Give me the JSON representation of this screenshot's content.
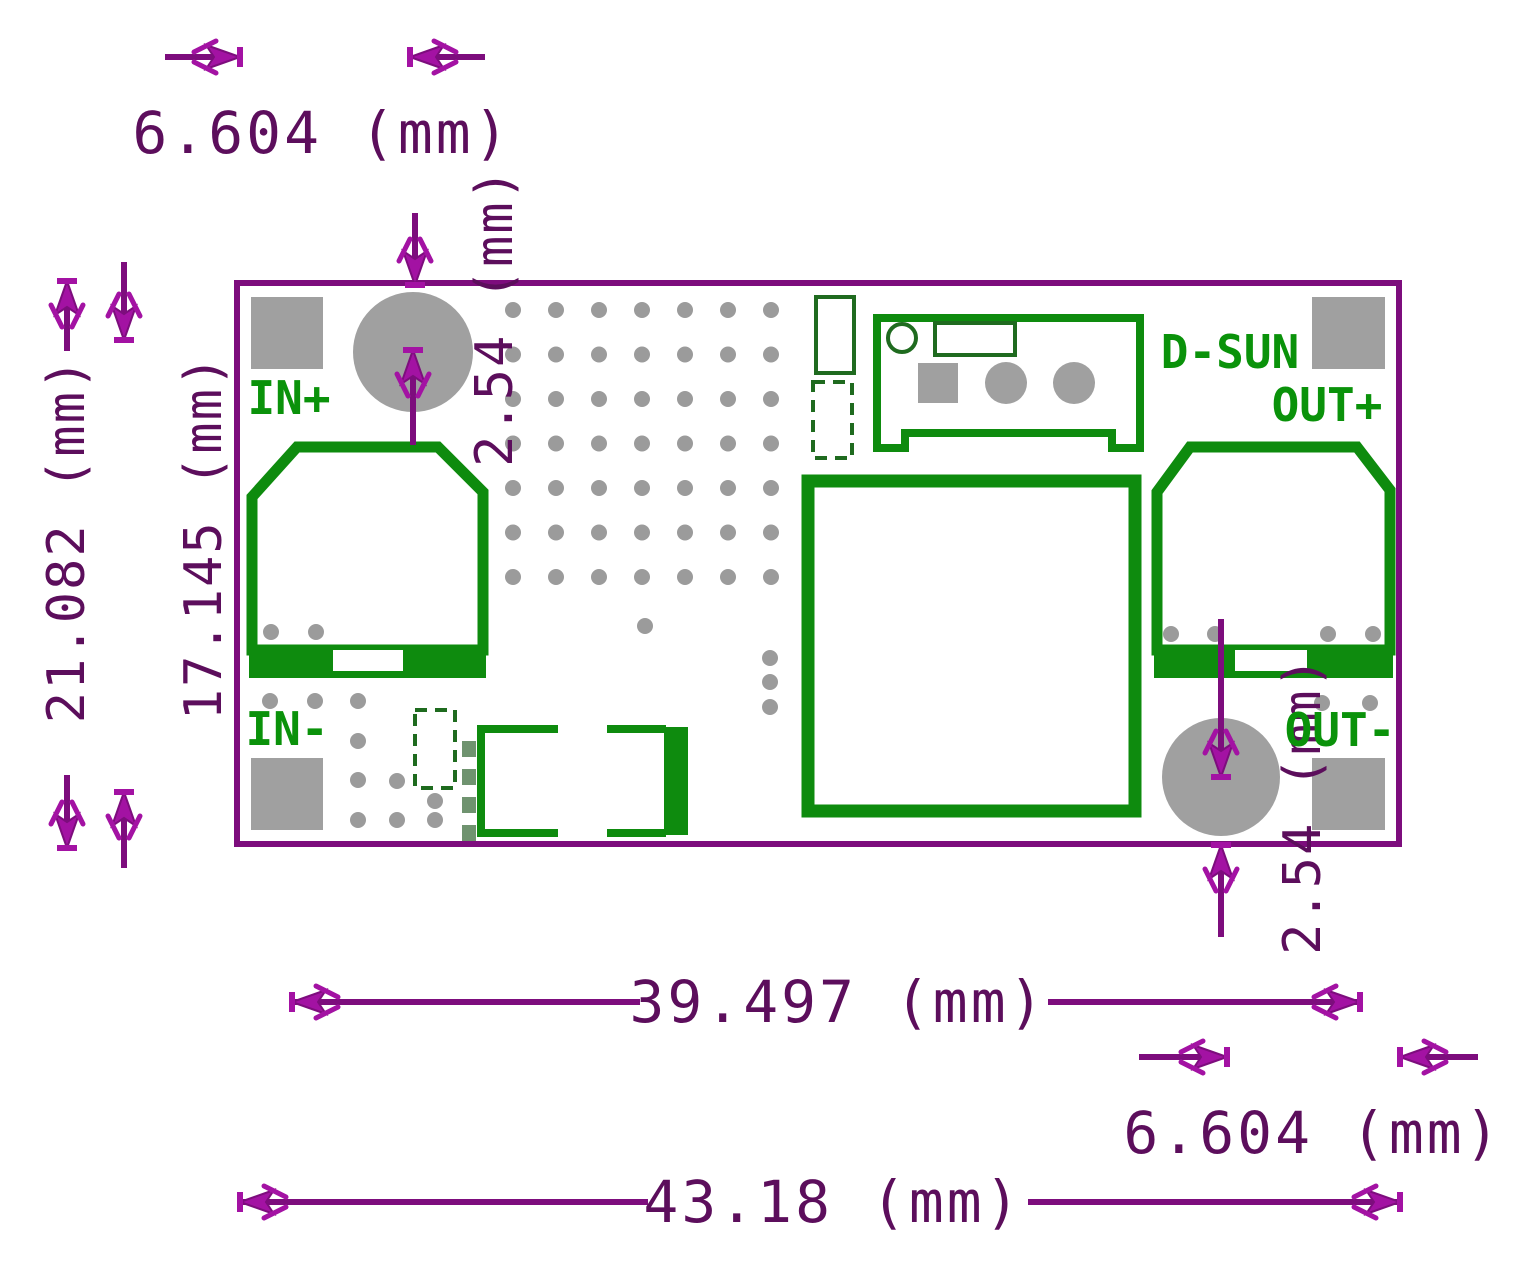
{
  "colors": {
    "dimension_text": "#5c0e5c",
    "dimension_line": "#7d0d7d",
    "arrow_fill": "#a312a3",
    "board_outline": "#7d0d7d",
    "silkscreen_green": "#0e8b0e",
    "silkscreen_dark_green": "#1f6b1f",
    "label_green": "#0a920a",
    "pad_gray": "#a0a0a0",
    "via_gray": "#9b9b9b",
    "background": "#ffffff"
  },
  "module": {
    "brand": "D-SUN",
    "pin_labels": {
      "in_plus": "IN+",
      "in_minus": "IN-",
      "out_plus": "OUT+",
      "out_minus": "OUT-"
    }
  },
  "dimensions": {
    "hole_offset_top": "6.604 (mm)",
    "hole_inset_top": "2.54 (mm)",
    "board_height": "21.082 (mm)",
    "pad_pitch_vertical": "17.145 (mm)",
    "pad_pitch_horizontal": "39.497 (mm)",
    "board_width": "43.18 (mm)",
    "hole_offset_bottom": "6.604 (mm)",
    "hole_inset_bottom": "2.54 (mm)"
  }
}
